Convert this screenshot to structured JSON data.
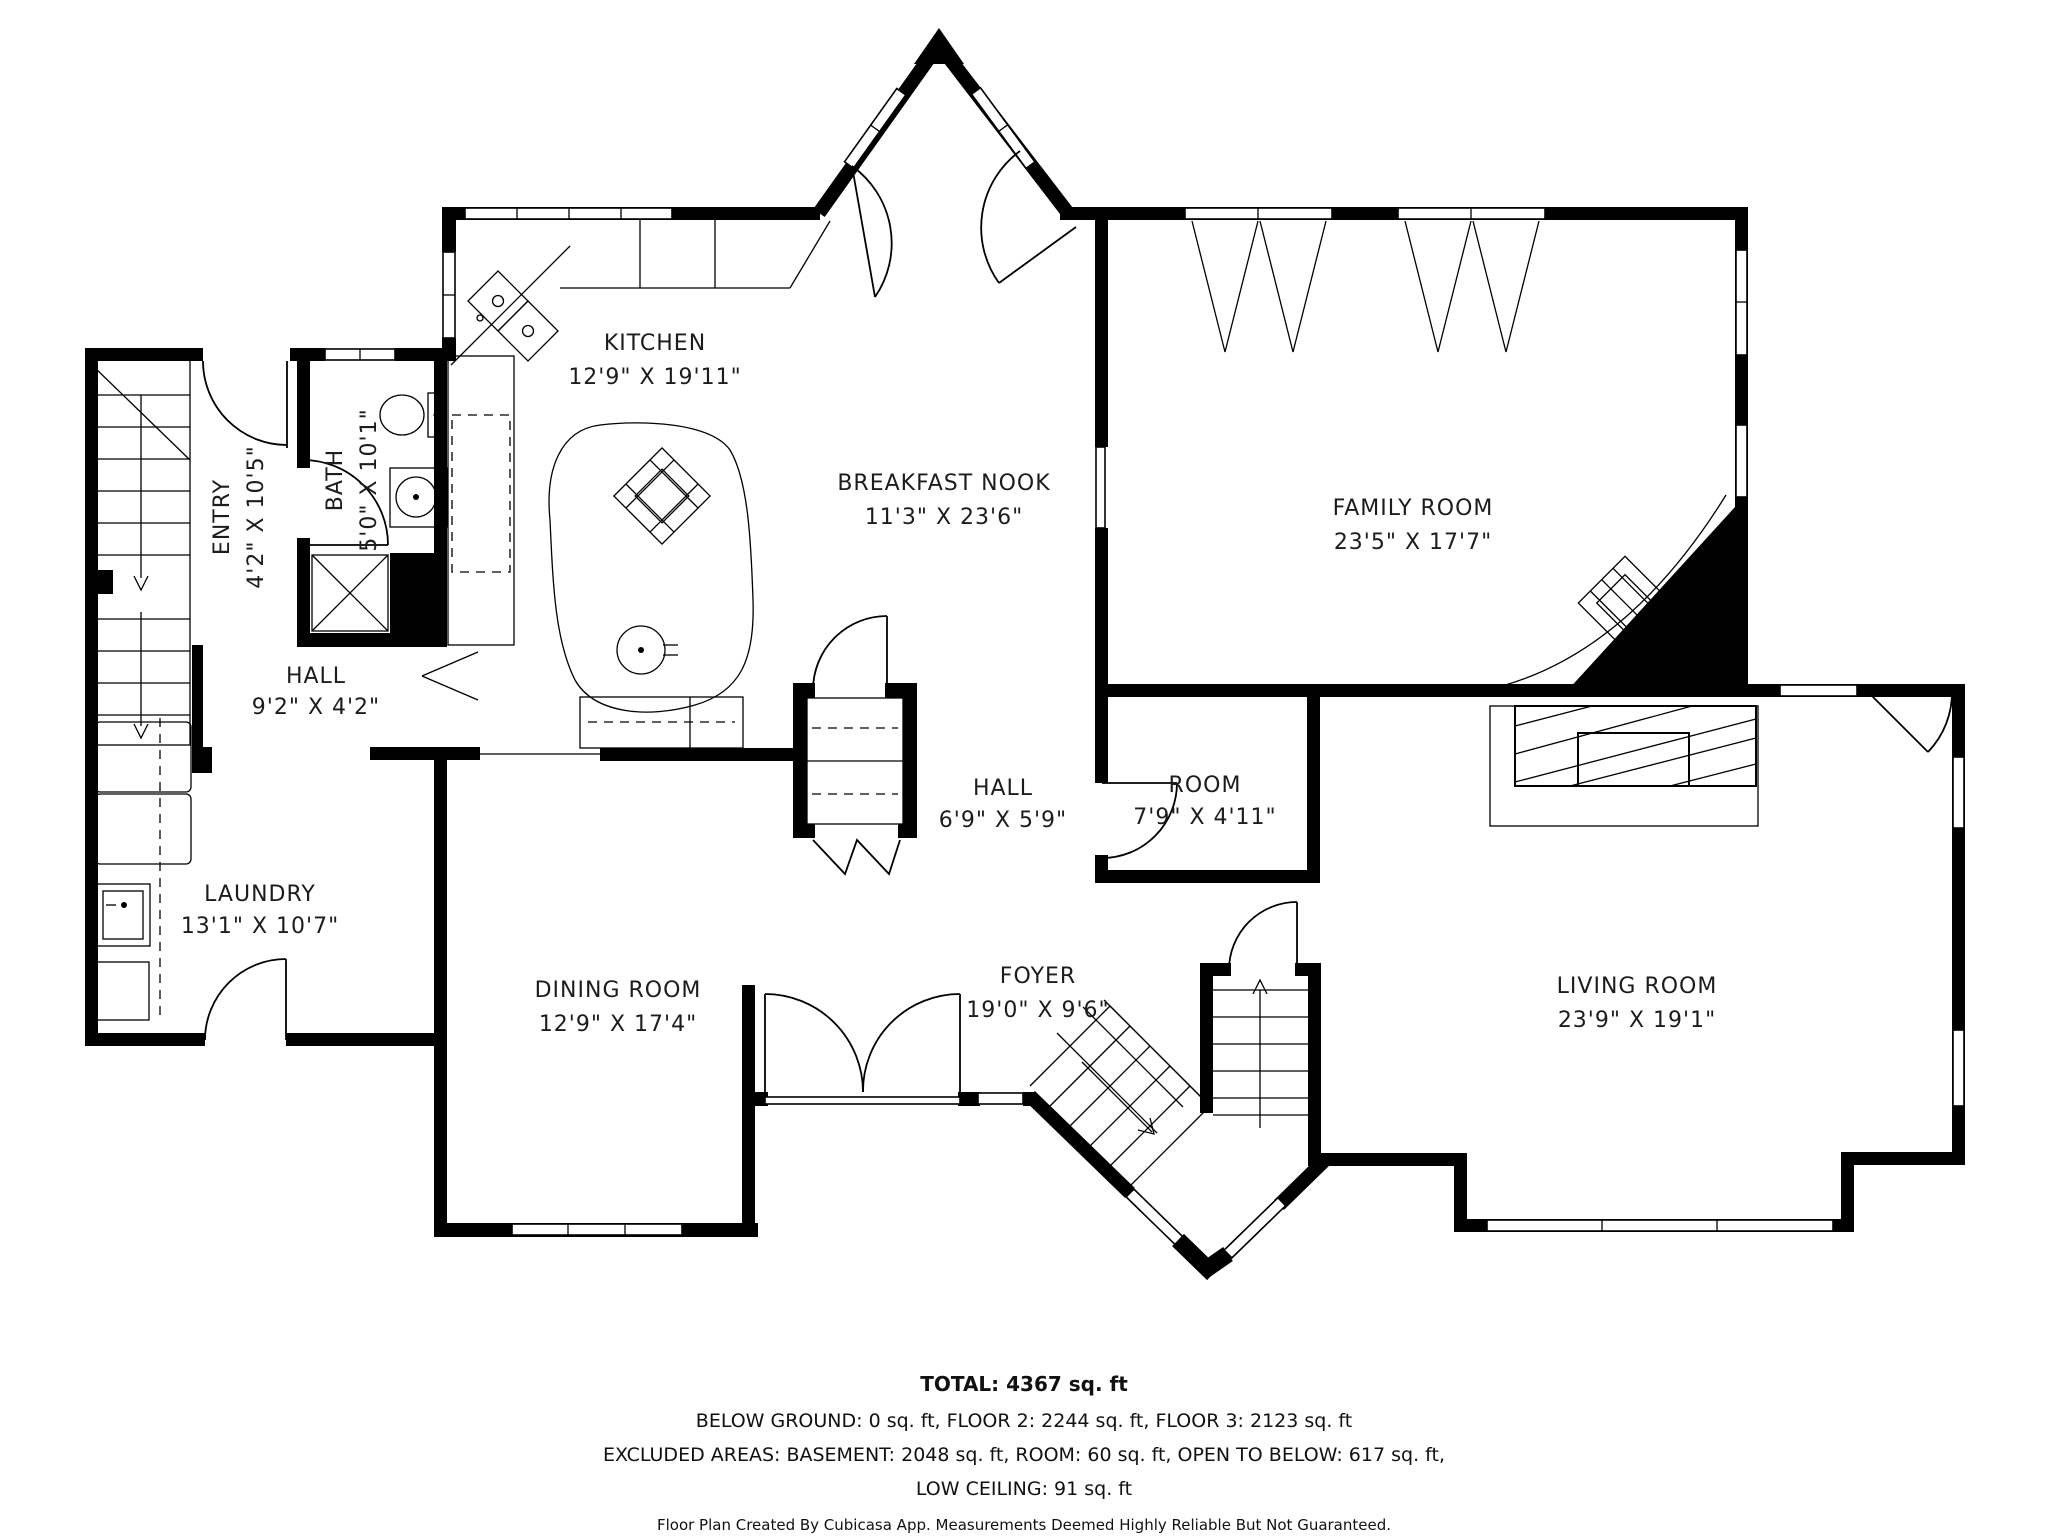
{
  "rooms": [
    {
      "name": "KITCHEN",
      "dims": "12'9\" X 19'11\""
    },
    {
      "name": "BREAKFAST NOOK",
      "dims": "11'3\" X 23'6\""
    },
    {
      "name": "FAMILY ROOM",
      "dims": "23'5\" X 17'7\""
    },
    {
      "name": "ENTRY",
      "dims": "4'2\" X 10'5\""
    },
    {
      "name": "BATH",
      "dims": "5'0\" X 10'1\""
    },
    {
      "name": "HALL",
      "dims": "9'2\" X 4'2\""
    },
    {
      "name": "LAUNDRY",
      "dims": "13'1\" X 10'7\""
    },
    {
      "name": "DINING ROOM",
      "dims": "12'9\" X 17'4\""
    },
    {
      "name": "HALL",
      "dims": "6'9\" X 5'9\""
    },
    {
      "name": "ROOM",
      "dims": "7'9\" X 4'11\""
    },
    {
      "name": "FOYER",
      "dims": "19'0\" X 9'6\""
    },
    {
      "name": "LIVING ROOM",
      "dims": "23'9\" X 19'1\""
    }
  ],
  "summary": {
    "total": "TOTAL: 4367 sq. ft",
    "line1": "BELOW GROUND: 0 sq. ft, FLOOR 2: 2244 sq. ft, FLOOR 3: 2123 sq. ft",
    "line2": "EXCLUDED AREAS: BASEMENT: 2048 sq. ft, ROOM: 60 sq. ft, OPEN TO BELOW: 617 sq. ft,",
    "line3": "LOW CEILING: 91 sq. ft",
    "disclaimer": "Floor Plan Created By Cubicasa App. Measurements Deemed Highly Reliable But Not Guaranteed."
  }
}
